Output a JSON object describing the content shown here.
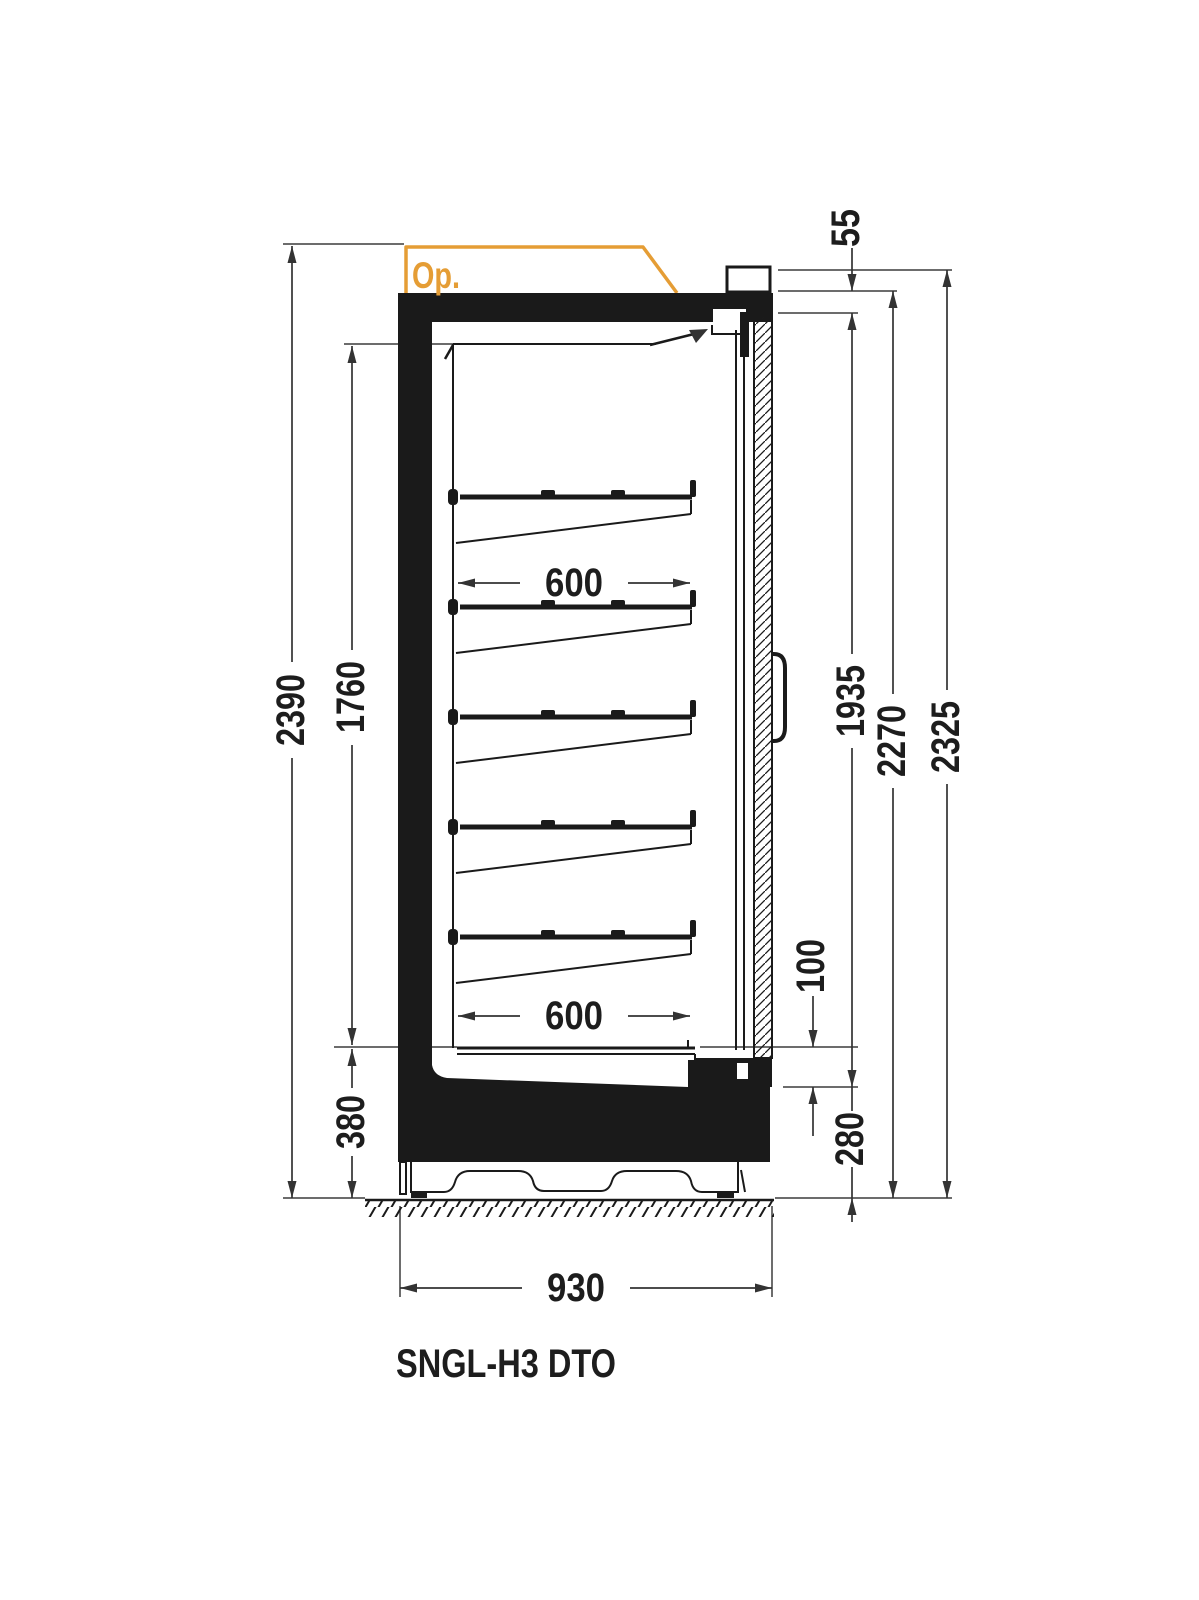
{
  "model": "SNGL-H3 DTO",
  "canopy": {
    "option_label": "Op."
  },
  "shelf_count": 5,
  "colors": {
    "line": "#1a1a1a",
    "dimension": "#333333",
    "accent_orange": "#e59d35",
    "background": "#ffffff"
  },
  "dims": {
    "overall_height_with_canopy": "2390",
    "interior_height": "1760",
    "base_height_left": "380",
    "shelf_depth_upper": "600",
    "shelf_depth_lower": "600",
    "overall_depth": "930",
    "canopy_step": "55",
    "door_glass_height": "1935",
    "door_top_height": "2270",
    "overall_height_right": "2325",
    "deck_to_door_gap": "100",
    "sill_height_right": "280"
  }
}
